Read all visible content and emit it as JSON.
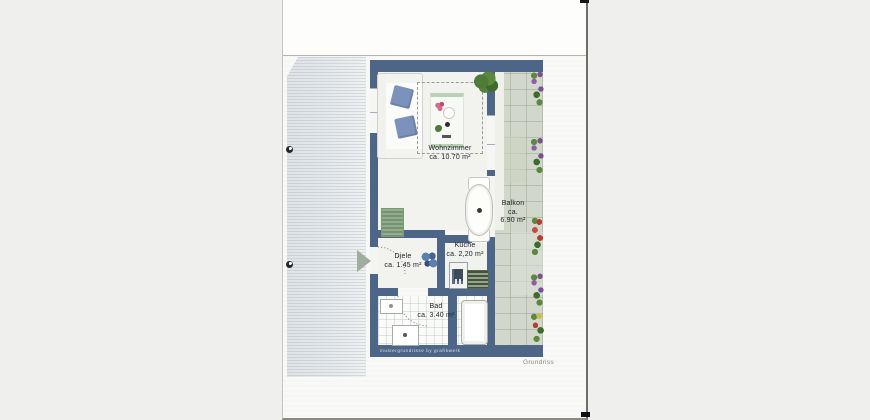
{
  "document": {
    "caption": "Grundriss",
    "watermark": "mustergrundrisse by grafikwerk"
  },
  "floorplan": {
    "rooms": {
      "wohnzimmer": {
        "name": "Wohnzimmer",
        "area": "ca. 10.70 m²"
      },
      "balkon": {
        "name": "Balkon",
        "area_prefix": "ca.",
        "area_value": "6.90 m²"
      },
      "kueche": {
        "name": "Küche",
        "area": "ca. 2,20 m²"
      },
      "diele": {
        "name": "Diele",
        "area": "ca. 1.45 m²"
      },
      "bad": {
        "name": "Bad",
        "area": "ca. 3.40 m²"
      }
    },
    "colors": {
      "wall": "#4d6586",
      "balcony_tile": "#d2d7cb",
      "floor": "#f2f3ef",
      "pillow_blue": "#7b93bc",
      "rug_green": "#b9d2b4",
      "plant_green": "#4e7a3a",
      "flower_red": "#b73a33",
      "flower_purple": "#7c4f93",
      "flower_yellow": "#d2bb45",
      "entrance_arrow": "#a0ac9e"
    }
  }
}
